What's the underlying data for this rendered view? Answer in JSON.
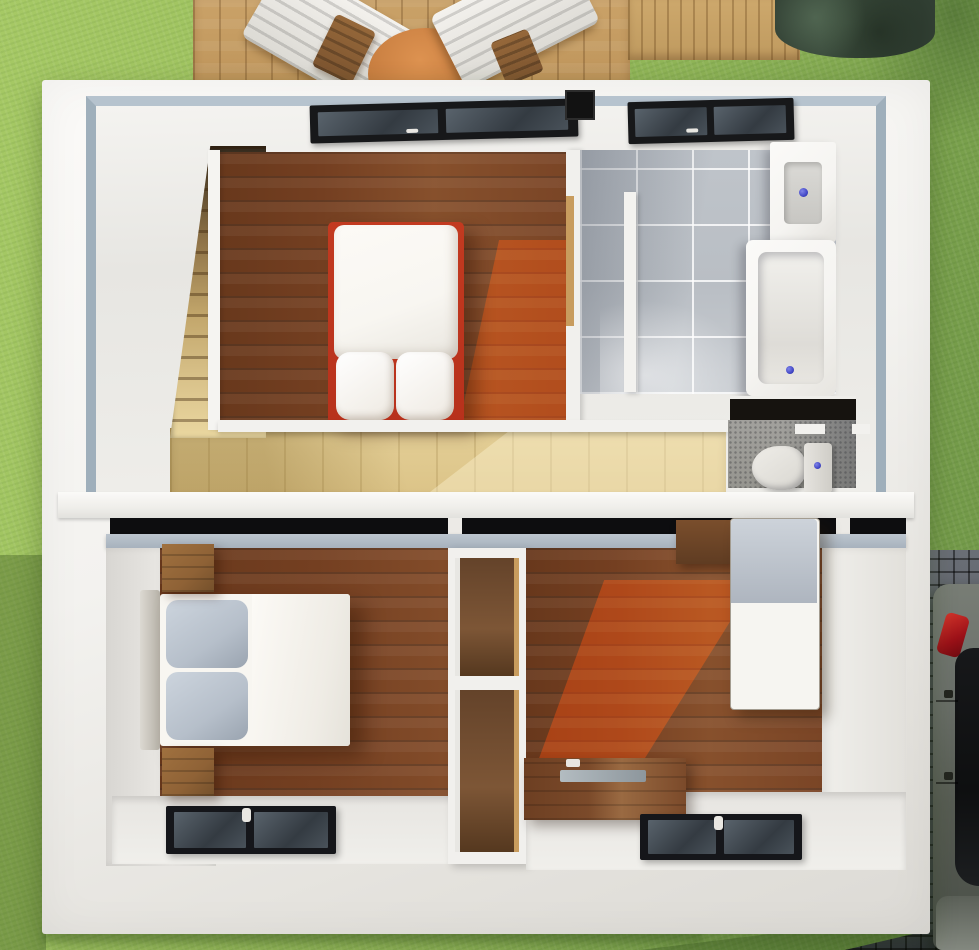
{
  "title": "Two-storey house 3D dollhouse floor-plan render, top-down cutaway view",
  "colors": {
    "grass_light": "#a6c965",
    "grass_mid": "#8fb457",
    "grass_dark": "#6e9447",
    "bush": "#3f5140",
    "cobble_light": "#6a6e76",
    "cobble_dark": "#474b52",
    "car_body": "#6b706a",
    "car_glass": "#0e0f10",
    "taillight": "#9c1118",
    "wall": "#f3f2ef",
    "wall_shade": "#dcdad5",
    "wood_dark": "#743f21",
    "landing": "#e4cf97",
    "stair": "#d9c28a",
    "tile": "#b9bec4",
    "wc": "#a2a19d",
    "fixture": "#f5f4f1",
    "drain_blue": "#3f44c4",
    "bed_red": "#b7311c",
    "bedding": "#f8f6f1",
    "pillow_gray": "#b6bfca",
    "nightstand": "#8f6236",
    "desk": "#7b4a2a",
    "door_tan": "#c89c5e",
    "glazing": "#0d0d0f",
    "sill": "#a7b2bd"
  },
  "scene": {
    "view": "overhead cutaway, roof removed, two floor sections stacked",
    "upper_floor": {
      "rooms": [
        "staircase",
        "bedroom",
        "bathroom",
        "wc",
        "landing"
      ],
      "skylights": 2,
      "roof_vents": 1,
      "furniture": [
        "double bed with red frame and two pillows",
        "washbasin unit",
        "bathtub",
        "toilet with cistern"
      ]
    },
    "lower_floor": {
      "rooms": [
        "double bedroom",
        "closet partition",
        "single bedroom"
      ],
      "roof_windows": 2,
      "furniture": [
        "double bed with gray pillows",
        "two nightstands",
        "single bed",
        "desk with laptop",
        "wall cabinet"
      ]
    },
    "exterior": {
      "items": [
        "lawn",
        "wooden deck",
        "two loungers",
        "two wooden chairs",
        "round orange table",
        "plank fence",
        "bush",
        "cobblestone driveway",
        "parked gray car"
      ]
    }
  }
}
